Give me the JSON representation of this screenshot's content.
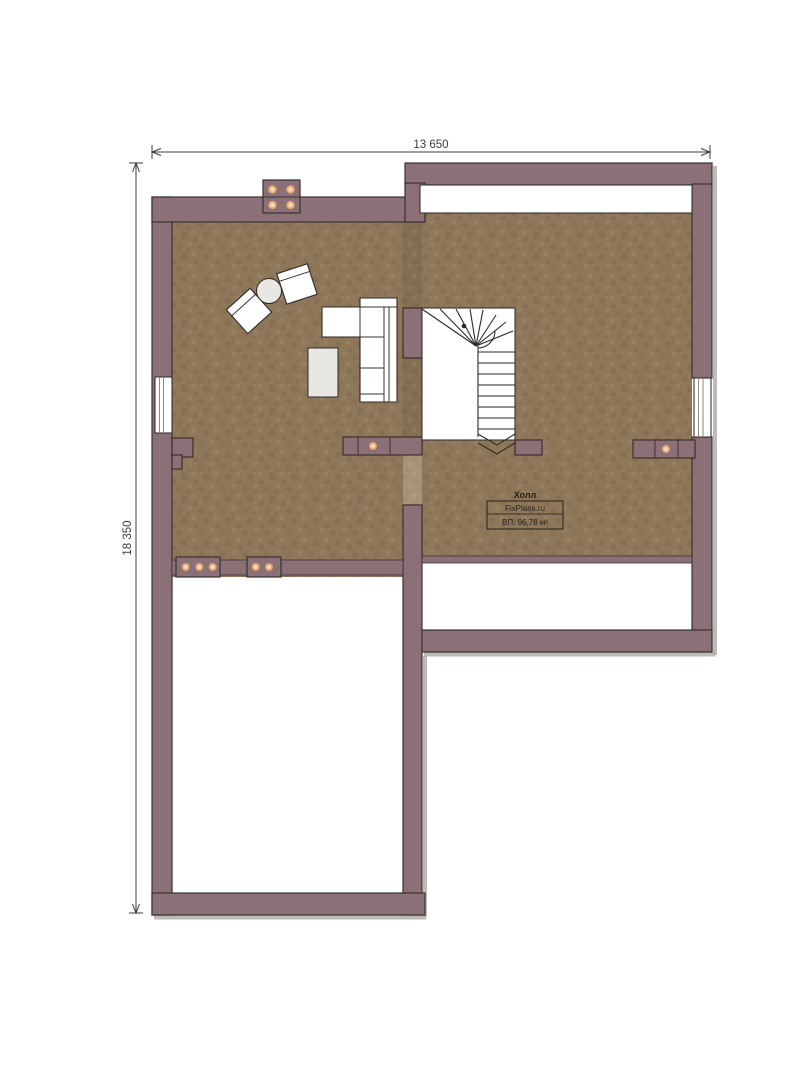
{
  "plan": {
    "room_label": "Холл",
    "watermark": "FixPlans.ru",
    "area_label": "ВП: 96,78 м²"
  },
  "dimensions": {
    "top": "13 650",
    "left": "18 350"
  },
  "icons": {
    "vent_dot": "orange-glow-circle"
  },
  "colors": {
    "wall": "#8b7177",
    "wall_outline": "#38322d",
    "floor": "#8f785a",
    "vent_dot": "#db945f",
    "furniture_fill": "#ffffff",
    "table_fill": "#e9e7e3",
    "dimension": "#3c3c3c",
    "background": "#ffffff"
  }
}
